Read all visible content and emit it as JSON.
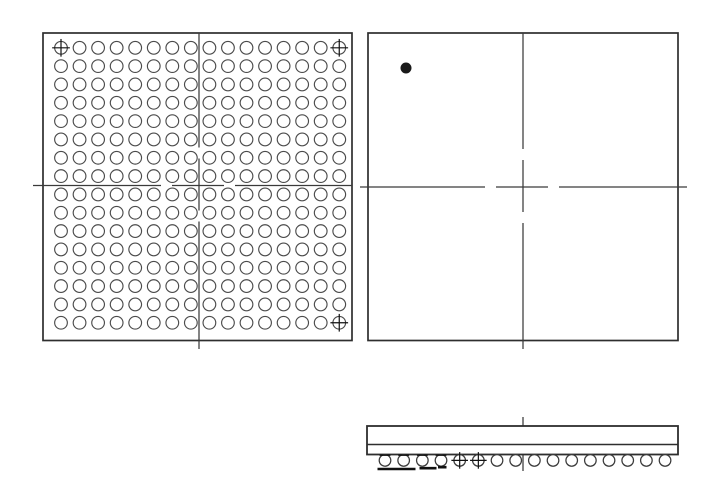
{
  "canvas": {
    "width": 708,
    "height": 487,
    "background": "#ffffff"
  },
  "style": {
    "outline_color": "#2e2e2e",
    "outline_width": 1.7,
    "ball_color": "#4b4b4b",
    "ball_width": 1.15,
    "centerline_color": "#3a3a3a",
    "centerline_width": 1.25,
    "mark_color": "#111111",
    "dot_color": "#1a1a1a"
  },
  "bottom_view": {
    "outline": {
      "x": 43,
      "y": 33,
      "w": 309,
      "h": 307.5
    },
    "grid": {
      "cols": 16,
      "rows": 16,
      "x0": 61,
      "y0": 47.8,
      "pitch_x": 18.55,
      "pitch_y": 18.33,
      "r": 6.35
    },
    "fiducials": [
      {
        "col": 0,
        "row": 0
      },
      {
        "col": 15,
        "row": 0
      },
      {
        "col": 15,
        "row": 15
      }
    ],
    "centerline": {
      "cx": 199,
      "cy": 185.5,
      "x_extent": [
        33,
        352
      ],
      "y_extent": [
        33,
        349
      ]
    }
  },
  "top_view": {
    "outline": {
      "x": 368,
      "y": 33,
      "w": 310,
      "h": 307.5
    },
    "pin1_dot": {
      "cx": 406,
      "cy": 68,
      "r": 5
    },
    "centerline": {
      "cx": 523,
      "cy": 187,
      "x_extent": [
        360,
        687
      ],
      "y_extent": [
        33,
        349
      ]
    }
  },
  "side_view": {
    "body": {
      "x": 367,
      "y": 426,
      "w": 311,
      "h": 28.5
    },
    "substrate_line_y": 444.5,
    "balls": {
      "count": 16,
      "x0": 385,
      "pitch": 18.67,
      "cy": 460.4,
      "r": 5.8
    },
    "flat_top_balls": [
      0,
      1,
      2,
      3
    ],
    "crosshair_balls": [
      4,
      5
    ],
    "underline_bars": [
      {
        "x1": 377.5,
        "x2": 415.5,
        "y": 469.0
      },
      {
        "x1": 419.5,
        "x2": 436.5,
        "y": 468.2
      },
      {
        "x1": 438.0,
        "x2": 446.5,
        "y": 467.2
      }
    ],
    "centerline": {
      "x": 523,
      "segments": [
        [
          417,
          444
        ],
        [
          451,
          471
        ]
      ]
    }
  }
}
